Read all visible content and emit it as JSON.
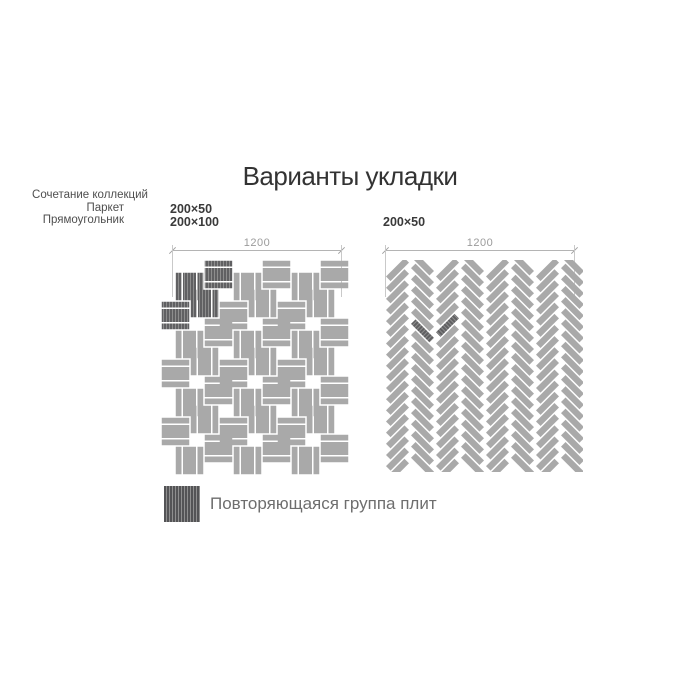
{
  "title": "Варианты укладки",
  "left": {
    "note": [
      "Сочетание коллекций",
      "Паркет",
      "Прямоугольник"
    ],
    "sizes": [
      "200×50",
      "200×100"
    ],
    "dimension_label": "1200",
    "pattern": {
      "type": "parquet-weave",
      "tile_sizes_mm": [
        "200×50",
        "200×100"
      ],
      "cols": 6,
      "rows": 7,
      "cell_px": 29,
      "gap_px": 1.5,
      "row_stagger_px": 7,
      "col_stagger_px": 6,
      "group_split": [
        0.25,
        0.5,
        0.25
      ],
      "highlight_cells": [
        [
          0,
          0
        ],
        [
          0,
          1
        ],
        [
          1,
          0
        ],
        [
          1,
          1
        ]
      ]
    }
  },
  "right": {
    "sizes": [
      "200×50"
    ],
    "dimension_label": "1200",
    "pattern": {
      "type": "herringbone-45",
      "tile_size_mm": "200×50",
      "columns": 8,
      "rows": 19,
      "col_width_px": 25,
      "row_spacing_px": 11.15,
      "tile_len_px": 27.6,
      "tile_w_px": 7.9,
      "gap_px": 1.5,
      "highlight_tiles": [
        [
          1,
          6
        ],
        [
          2,
          5
        ]
      ]
    }
  },
  "legend": {
    "label": "Повторяющаяся группа плит"
  },
  "colors": {
    "background": "#ffffff",
    "tile": "#a9a9a9",
    "tile_dark": "#606062",
    "hatch": "#8d8d8d",
    "swatch": "#545456",
    "swatch_hatch": "#8f8f8f",
    "dim_line": "#b4b4b4",
    "dim_text": "#9b9b9b",
    "title_text": "#333333",
    "note_text": "#4f4f4f",
    "size_text": "#3a3a3a",
    "legend_text": "#6e6e6e"
  }
}
